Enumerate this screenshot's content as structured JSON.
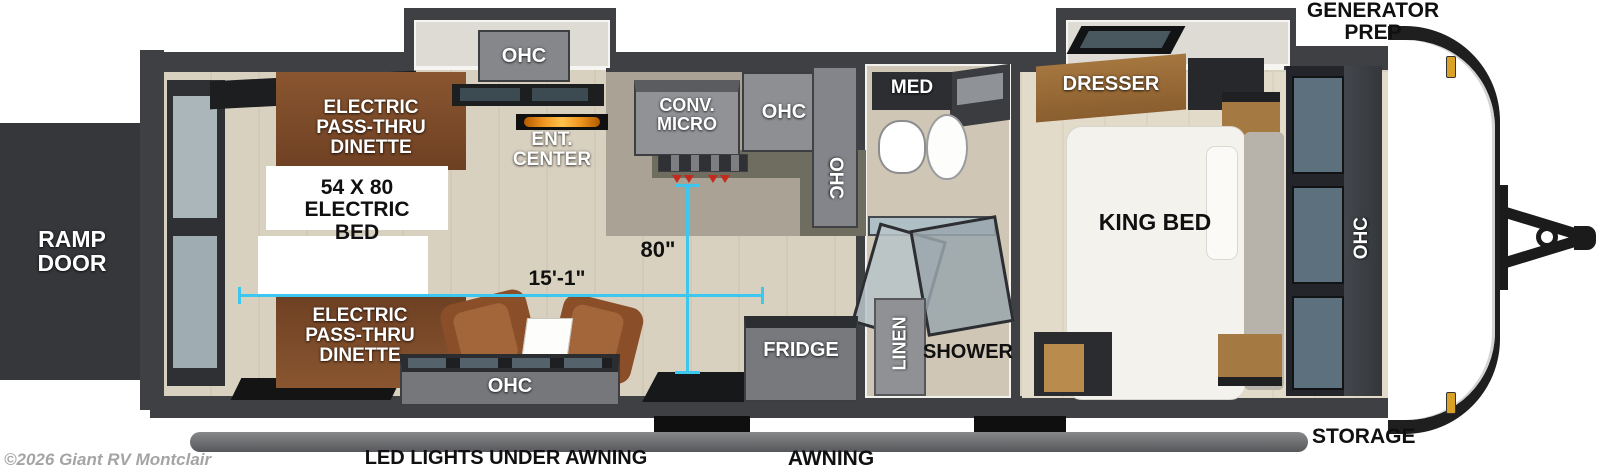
{
  "page": {
    "watermark": "©2026 Giant RV Montclair"
  },
  "annotations": {
    "ramp_door": "RAMP DOOR",
    "generator_prep": "GENERATOR PREP",
    "storage": "STORAGE",
    "awning": "AWNING",
    "led_lights": "LED LIGHTS UNDER AWNING",
    "dim_bed_width": "80\"",
    "dim_length": "15'-1\""
  },
  "garage": {
    "dinette_rear": "ELECTRIC PASS-THRU DINETTE",
    "dinette_front": "ELECTRIC PASS-THRU DINETTE",
    "electric_bed": "54 X 80 ELECTRIC BED",
    "ent_center": "ENT. CENTER",
    "ohc_slideout": "OHC",
    "conv_micro": "CONV. MICRO",
    "ohc_kitchen": "OHC",
    "ohc_kitchen_end": "OHC",
    "ohc_front": "OHC",
    "fridge": "FRIDGE"
  },
  "bathroom": {
    "med": "MED",
    "shower": "SHOWER",
    "linen": "LINEN"
  },
  "bedroom": {
    "dresser": "DRESSER",
    "king_bed": "KING BED",
    "ohc": "OHC"
  },
  "colors": {
    "measurement_cyan": "#3CC7F0",
    "wall_gray": "#3E4043",
    "dinette_brown": "#8A5630",
    "cabinet_gray": "#8B8D8F",
    "flame_orange": "#F0941E",
    "floor_tan": "#D9D1C0",
    "marker_amber": "#D9A225"
  }
}
